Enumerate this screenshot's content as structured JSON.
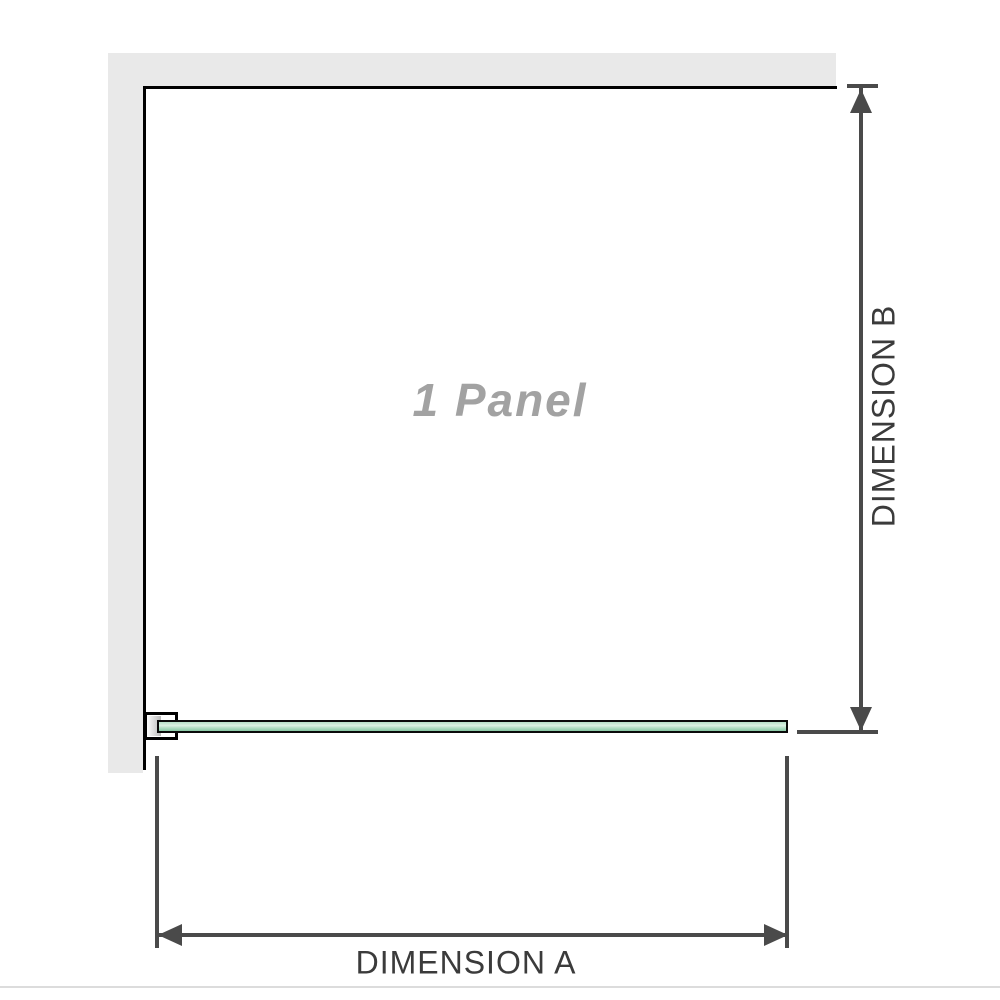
{
  "colors": {
    "wall": "#e9e9e9",
    "outline": "#000000",
    "dimension_line": "#4a4a4a",
    "dimension_text": "#3b3b3b",
    "panel_text": "#a2a2a2",
    "glass_light": "#dcf1e3",
    "glass_mid": "#b7e0c8",
    "glass_dark": "#88c9a4",
    "baseline": "#dcdcdc"
  },
  "diagram": {
    "panel_label": "1 Panel",
    "dimension_a_label": "DIMENSION A",
    "dimension_b_label": "DIMENSION B",
    "icons": {
      "arrow_up": "triangle-up",
      "arrow_down": "triangle-down",
      "arrow_left": "triangle-left",
      "arrow_right": "triangle-right"
    }
  }
}
